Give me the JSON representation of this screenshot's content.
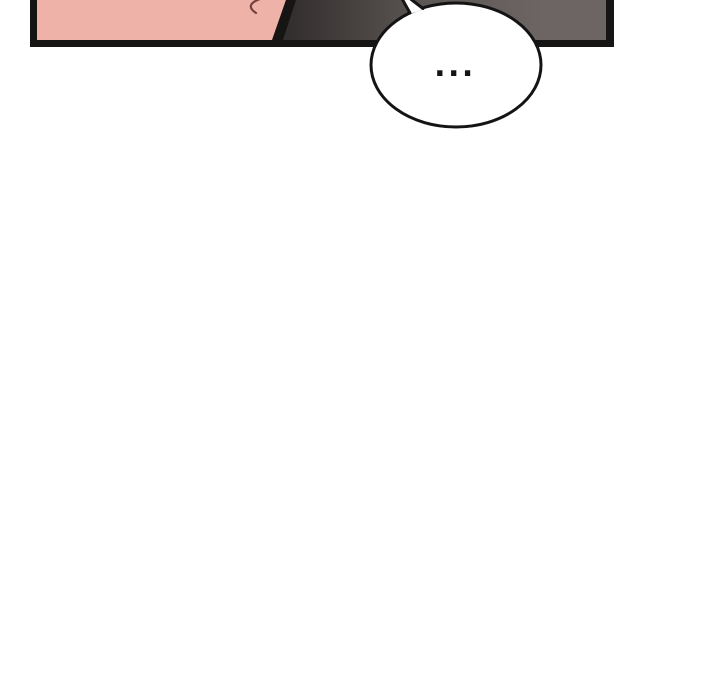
{
  "page": {
    "background_color": "#ffffff"
  },
  "comic": {
    "panel": {
      "border_color": "#171414",
      "skin_color": "#efb2a9",
      "hair_stroke_color": "#74423e",
      "shadow_gradient": {
        "from": "#332f2e",
        "mid": "#5e5856",
        "to": "#6c6563"
      }
    },
    "speech_bubble": {
      "text": "...",
      "fill_color": "#ffffff",
      "outline_color": "#141414",
      "text_color": "#141414"
    }
  }
}
